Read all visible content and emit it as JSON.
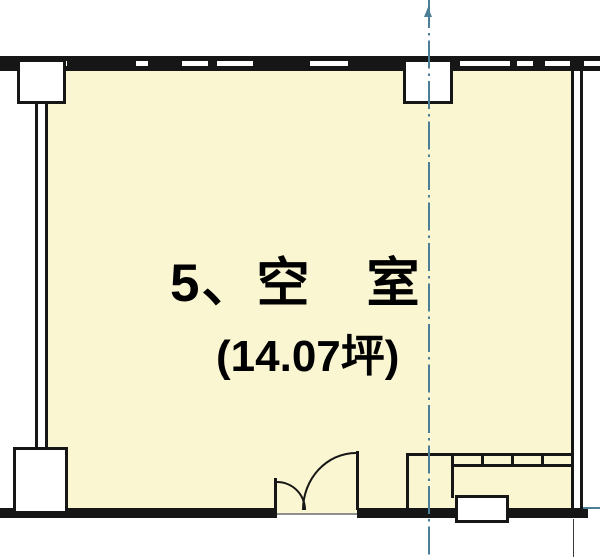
{
  "plan": {
    "room_label": "5、空　室",
    "area_label": "(14.07坪)",
    "room_number": "5",
    "room_status": "空室",
    "area_tsubo": "14.07"
  },
  "colors": {
    "background": "#FFFFFF",
    "room_fill": "#FBF6D2",
    "wall": "#161616",
    "centerline": "#4C7E95",
    "threshold": "#8F8F8F",
    "pillar_fill": "#FFFFFF"
  }
}
